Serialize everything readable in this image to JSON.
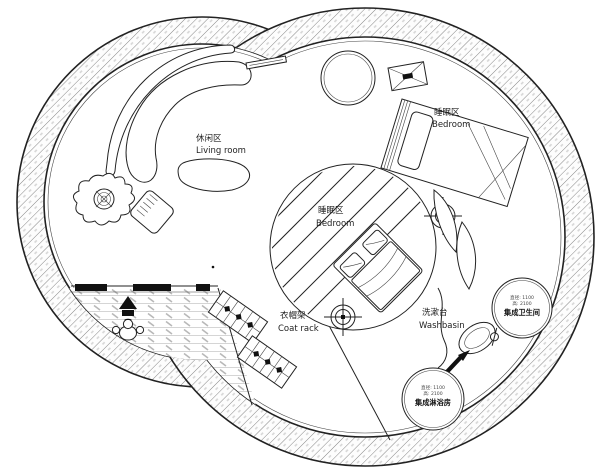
{
  "plan": {
    "type": "circular-house-floor-plan",
    "colors": {
      "line": "#222222",
      "wall_hatch": "#777777",
      "deck_hatch": "#aaaaaa",
      "background": "#ffffff",
      "solid_fill": "#111111"
    },
    "icons": [
      "plant-icon",
      "person-icon",
      "entry-arrow-icon",
      "column-marker-icon",
      "washbasin-icon",
      "direction-arrow-icon",
      "x-crossed-table-icon"
    ]
  },
  "areas": {
    "living_room": {
      "label_zh": "休闲区",
      "label_en": "Living room"
    },
    "bedroom_upper": {
      "label_zh": "睡眠区",
      "label_en": "Bedroom"
    },
    "bedroom_center": {
      "label_zh": "睡眠区",
      "label_en": "Bedroom"
    },
    "coat_rack": {
      "label_zh": "衣帽架",
      "label_en": "Coat rack"
    },
    "washbasin": {
      "label_zh": "洗漱台",
      "label_en": "Washbasin"
    },
    "bathroom_pod": {
      "dim_line1": "直径: 1100",
      "dim_line2": "高: 2100",
      "label_zh": "集成卫生间"
    },
    "shower_pod": {
      "dim_line1": "直径: 1100",
      "dim_line2": "高: 2100",
      "label_zh": "集成淋浴房"
    }
  }
}
